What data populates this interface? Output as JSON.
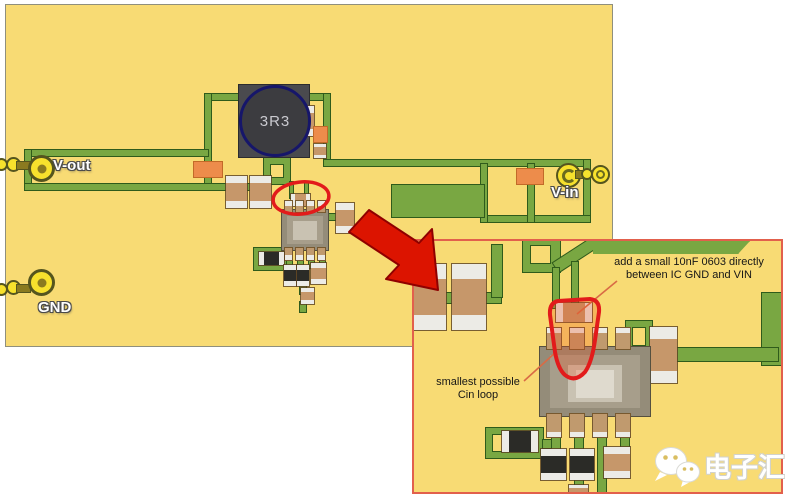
{
  "title": "PCB layout with input-capacitor placement detail",
  "colors": {
    "board_bg": "#F8DB74",
    "trace_green": "#79A742",
    "trace_outline": "#2F5B1B",
    "inset_border": "#E2604C",
    "highlight_red": "#E21B1B",
    "arrow_red": "#DC1400",
    "component_tan": "#C6976A",
    "component_orange": "#ED8C4B",
    "pad_yellow": "#F7E12D"
  },
  "board": {
    "connectors": {
      "vout": "V-out",
      "vin": "V-in",
      "gnd": "GND"
    },
    "inductor": {
      "label": "3R3"
    }
  },
  "inset": {
    "note_cap": {
      "line1": "add a small 10nF 0603 directly",
      "line2": "between IC GND and VIN"
    },
    "note_loop": {
      "line1": "smallest possible",
      "line2": "Cin loop"
    }
  },
  "watermark": {
    "label": "电子汇"
  }
}
